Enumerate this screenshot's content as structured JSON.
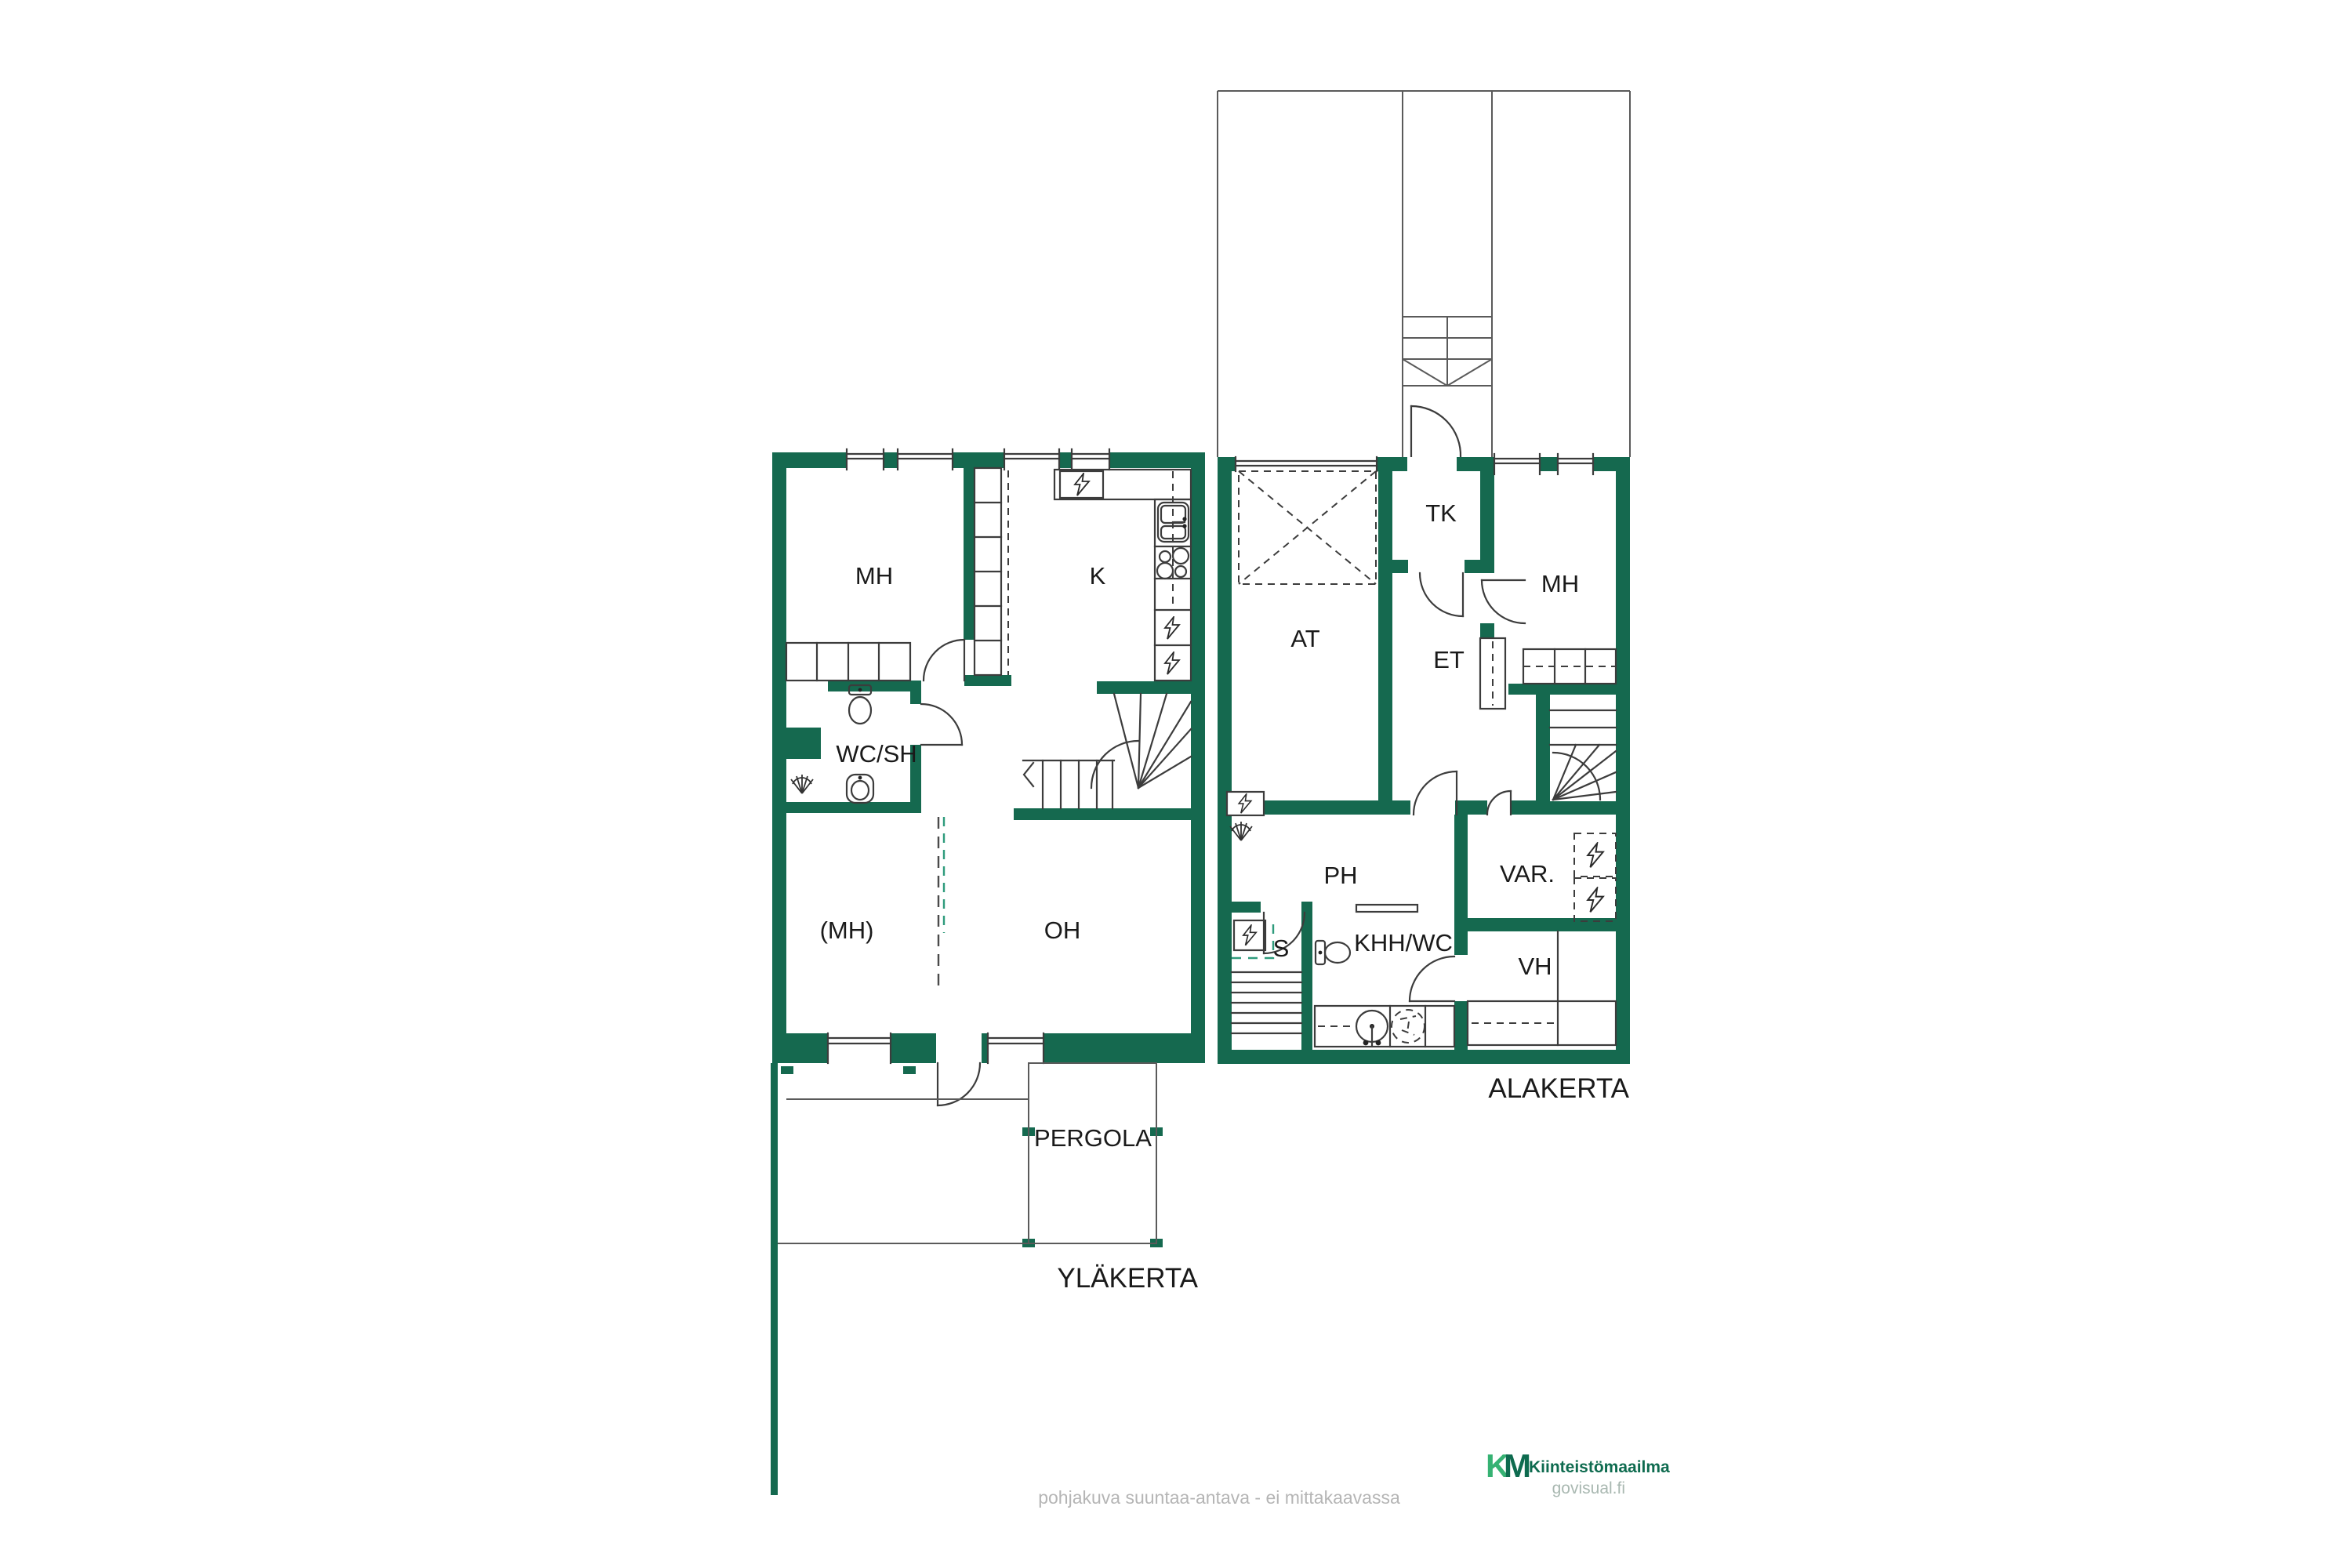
{
  "colors": {
    "wall": "#15694F",
    "accent": "#2E9B7C",
    "line": "#3c3c3c",
    "label": "#1a1a1a",
    "muted_text": "#b5b5b5",
    "brand_green_dark": "#0E6B4F",
    "brand_green_light": "#36B273",
    "watermark_gray": "#a9b8b1"
  },
  "upper_floor": {
    "floor_label": "YLÄKERTA",
    "rooms": {
      "mh": "MH",
      "k": "K",
      "wc_sh": "WC/SH",
      "mh_optional": "(MH)",
      "oh": "OH"
    },
    "outdoor": {
      "pergola": "PERGOLA"
    }
  },
  "lower_floor": {
    "floor_label": "ALAKERTA",
    "rooms": {
      "at": "AT",
      "tk": "TK",
      "mh": "MH",
      "et": "ET",
      "ph": "PH",
      "s": "S",
      "khh_wc": "KHH/WC",
      "var": "VAR.",
      "vh": "VH"
    }
  },
  "footer": {
    "disclaimer": "pohjakuva suuntaa-antava - ei mittakaavassa"
  },
  "branding": {
    "logo_k": "K",
    "logo_m": "M",
    "name": "Kiinteistömaailma",
    "site": "govisual.fi"
  }
}
